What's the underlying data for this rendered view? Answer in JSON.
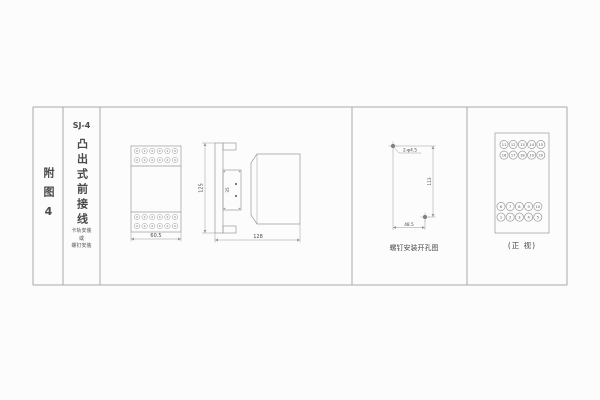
{
  "colors": {
    "bg": "#fcfcfc",
    "line": "#9a9a9a",
    "border": "#aaaaaa",
    "text": "#4a4a4a"
  },
  "title_block": {
    "figure_label": "附图4",
    "model": "SJ-4",
    "type_vertical": "凸出式前接线",
    "mount_lines": [
      "卡轨安装",
      "或",
      "螺钉安装"
    ]
  },
  "front_view": {
    "width_dim": "60.5"
  },
  "side_view": {
    "height_dim": "125",
    "clip_dim": "35",
    "depth_dim": "128"
  },
  "drill_template": {
    "hole_label": "2-φ4.5",
    "height_dim": "113",
    "width_dim": "48.5",
    "caption": "螺钉安装开孔图"
  },
  "terminal_view": {
    "caption": "(正 视)",
    "top_rows": [
      [
        "11",
        "12",
        "13",
        "14",
        "15"
      ],
      [
        "16",
        "17",
        "18",
        "19",
        "20"
      ]
    ],
    "bottom_rows": [
      [
        "6",
        "7",
        "8",
        "9",
        "10"
      ],
      [
        "1",
        "2",
        "3",
        "4",
        "5"
      ]
    ]
  }
}
